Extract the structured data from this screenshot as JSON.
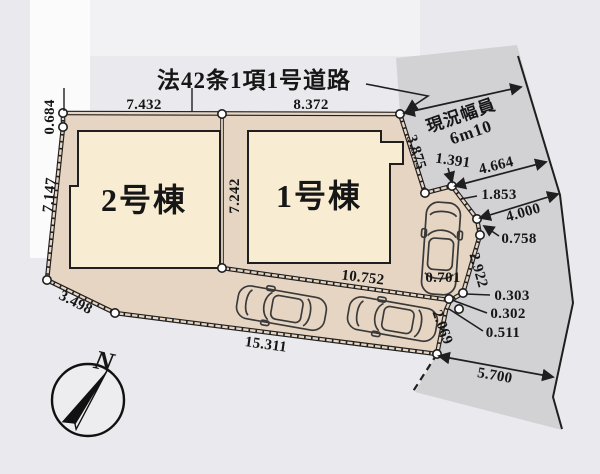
{
  "labels": {
    "road_law": "法42条1項1号道路",
    "road_width_caption": "現況幅員",
    "road_width_value": "6m10",
    "north": "N"
  },
  "buildings": [
    {
      "label": "2号棟"
    },
    {
      "label": "1号棟"
    }
  ],
  "dimensions": {
    "top_edge_left": "7.432",
    "top_edge_right": "8.372",
    "left_top": "0.684",
    "left_side": "7.147",
    "lower_left": "3.498",
    "bottom": "15.311",
    "center_divider": "7.242",
    "front_line": "10.752",
    "road_upper_edge": "3.875",
    "road_step1": "1.391",
    "road_width_upper": "4.664",
    "road_step2": "1.853",
    "road_width_mid": "4.000",
    "road_step3": "0.758",
    "car_bay": "0.701",
    "right_side": "2.922",
    "right_small1": "0.303",
    "right_small2": "0.302",
    "right_small3": "0.511",
    "lower_right": "2.069",
    "road_width_lower": "5.700"
  },
  "icons": {
    "car": "car-top-view",
    "compass": "compass-north-arrow"
  },
  "colors": {
    "background": "#eaeaee",
    "land": "#e6d5c3",
    "building": "#f8edd2",
    "road": "#d2d2d5",
    "line": "#1f1f1f"
  }
}
